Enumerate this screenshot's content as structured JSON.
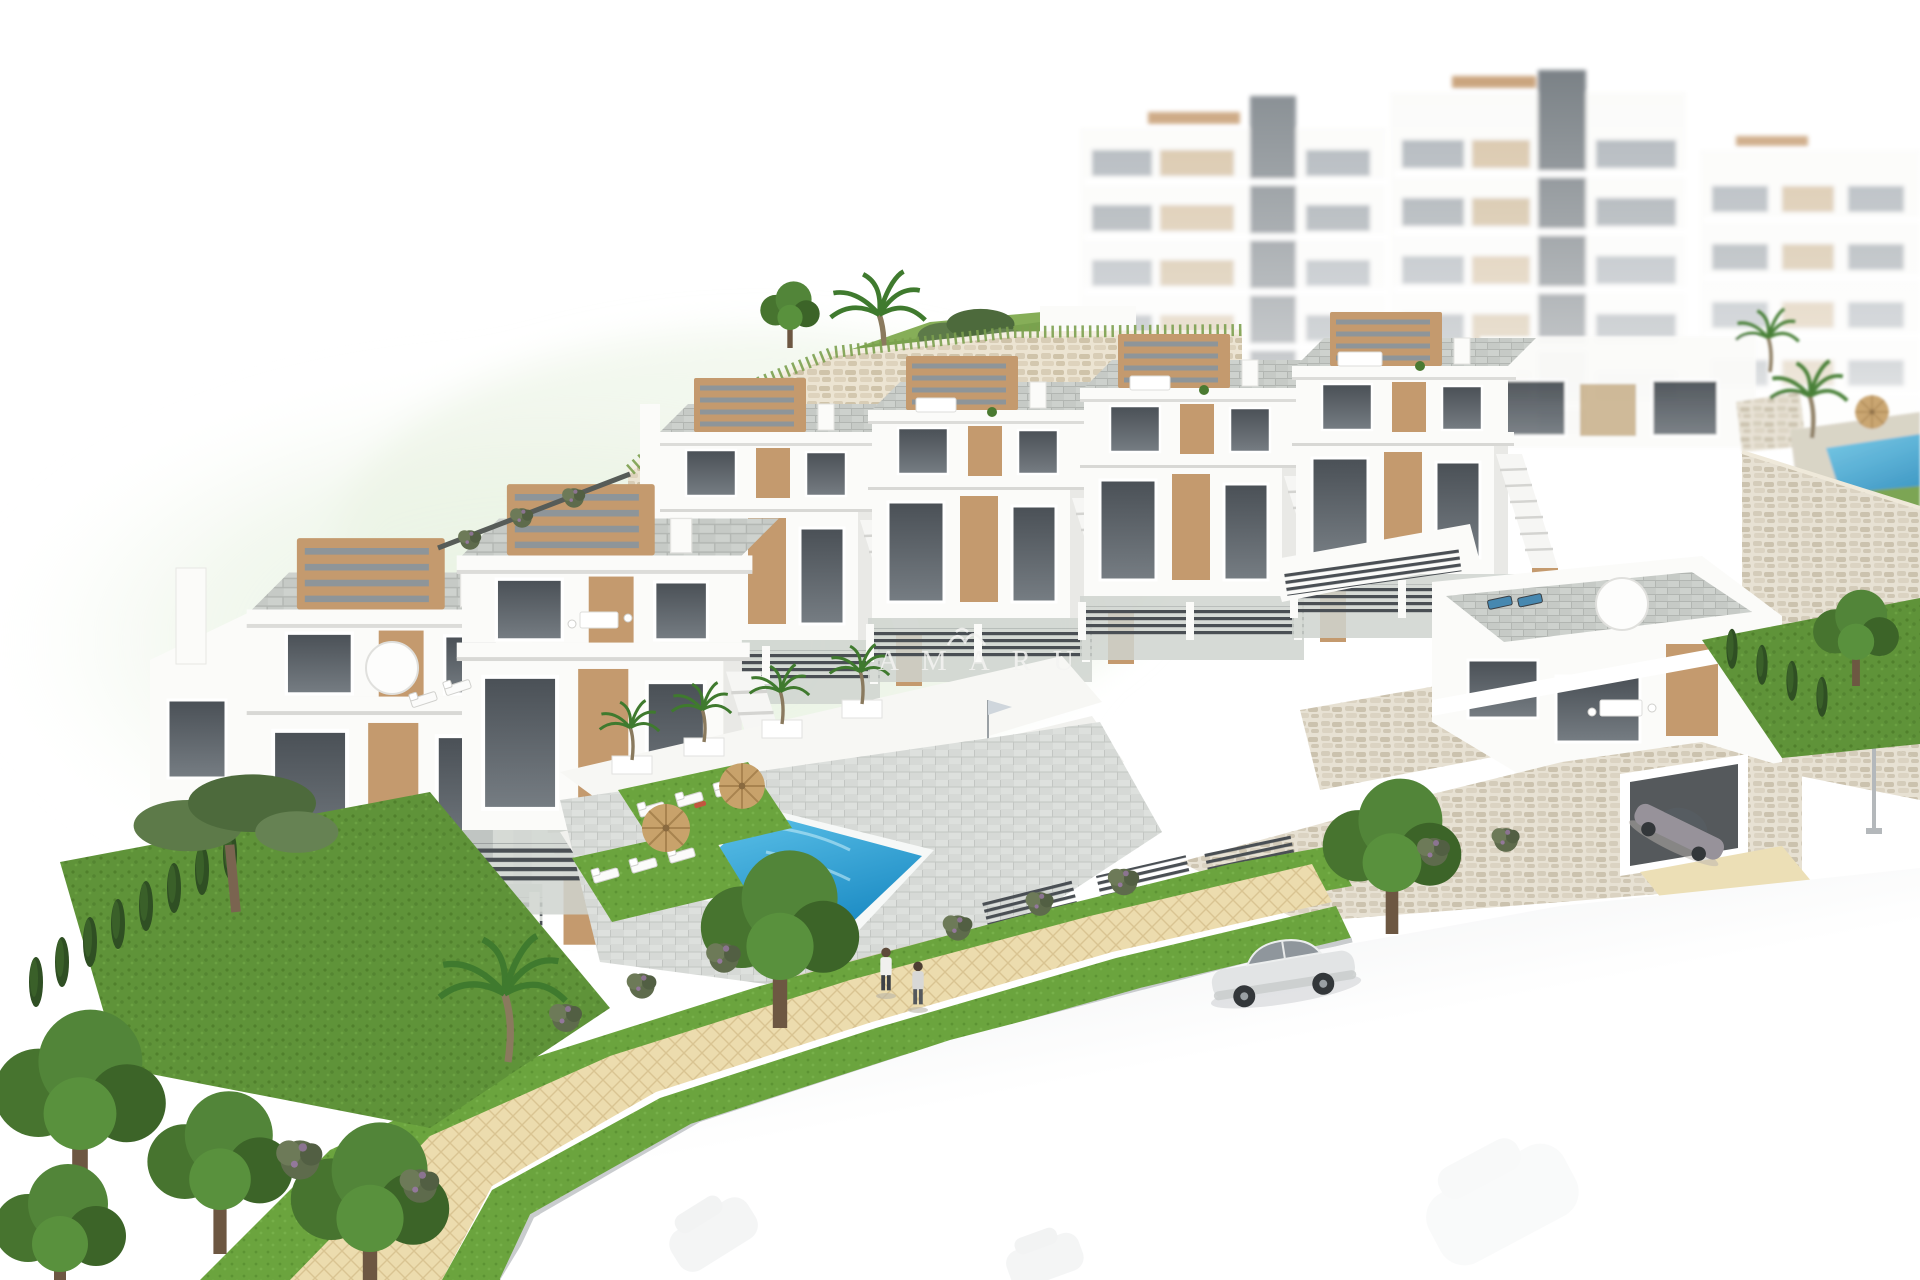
{
  "watermark": {
    "text": "AMARU",
    "logo_icon": "amaru-logo"
  },
  "colors": {
    "bg": "#ffffff",
    "blob-green": "#e3efdb",
    "building-white": "#fbfbf9",
    "building-shade": "#e9e9e6",
    "window-dark": "#3d4349",
    "window-haze": "#a5acb2",
    "accent-tan": "#c49a6e",
    "accent-tan-dark": "#a87f55",
    "pergola-slat": "#8e9599",
    "fence-dark": "#4a4f54",
    "stone": "#e8e0cf",
    "stone-dark": "#cfc3aa",
    "paver": "#c9cdc9",
    "deck": "#d8dbd8",
    "pool-light": "#62c6ec",
    "pool-dark": "#1e8dc5",
    "lawn": "#5f9339",
    "grass-bright": "#6ba43e",
    "tree-green": "#47742f",
    "tree-dark": "#2f4f23",
    "sand": "#ecdcae",
    "sand-line": "#d9c492",
    "road": "#e7e9ea",
    "car-silver": "#e2e4e5",
    "car-gray": "#97929a",
    "watermark": "#f4f4f2"
  }
}
